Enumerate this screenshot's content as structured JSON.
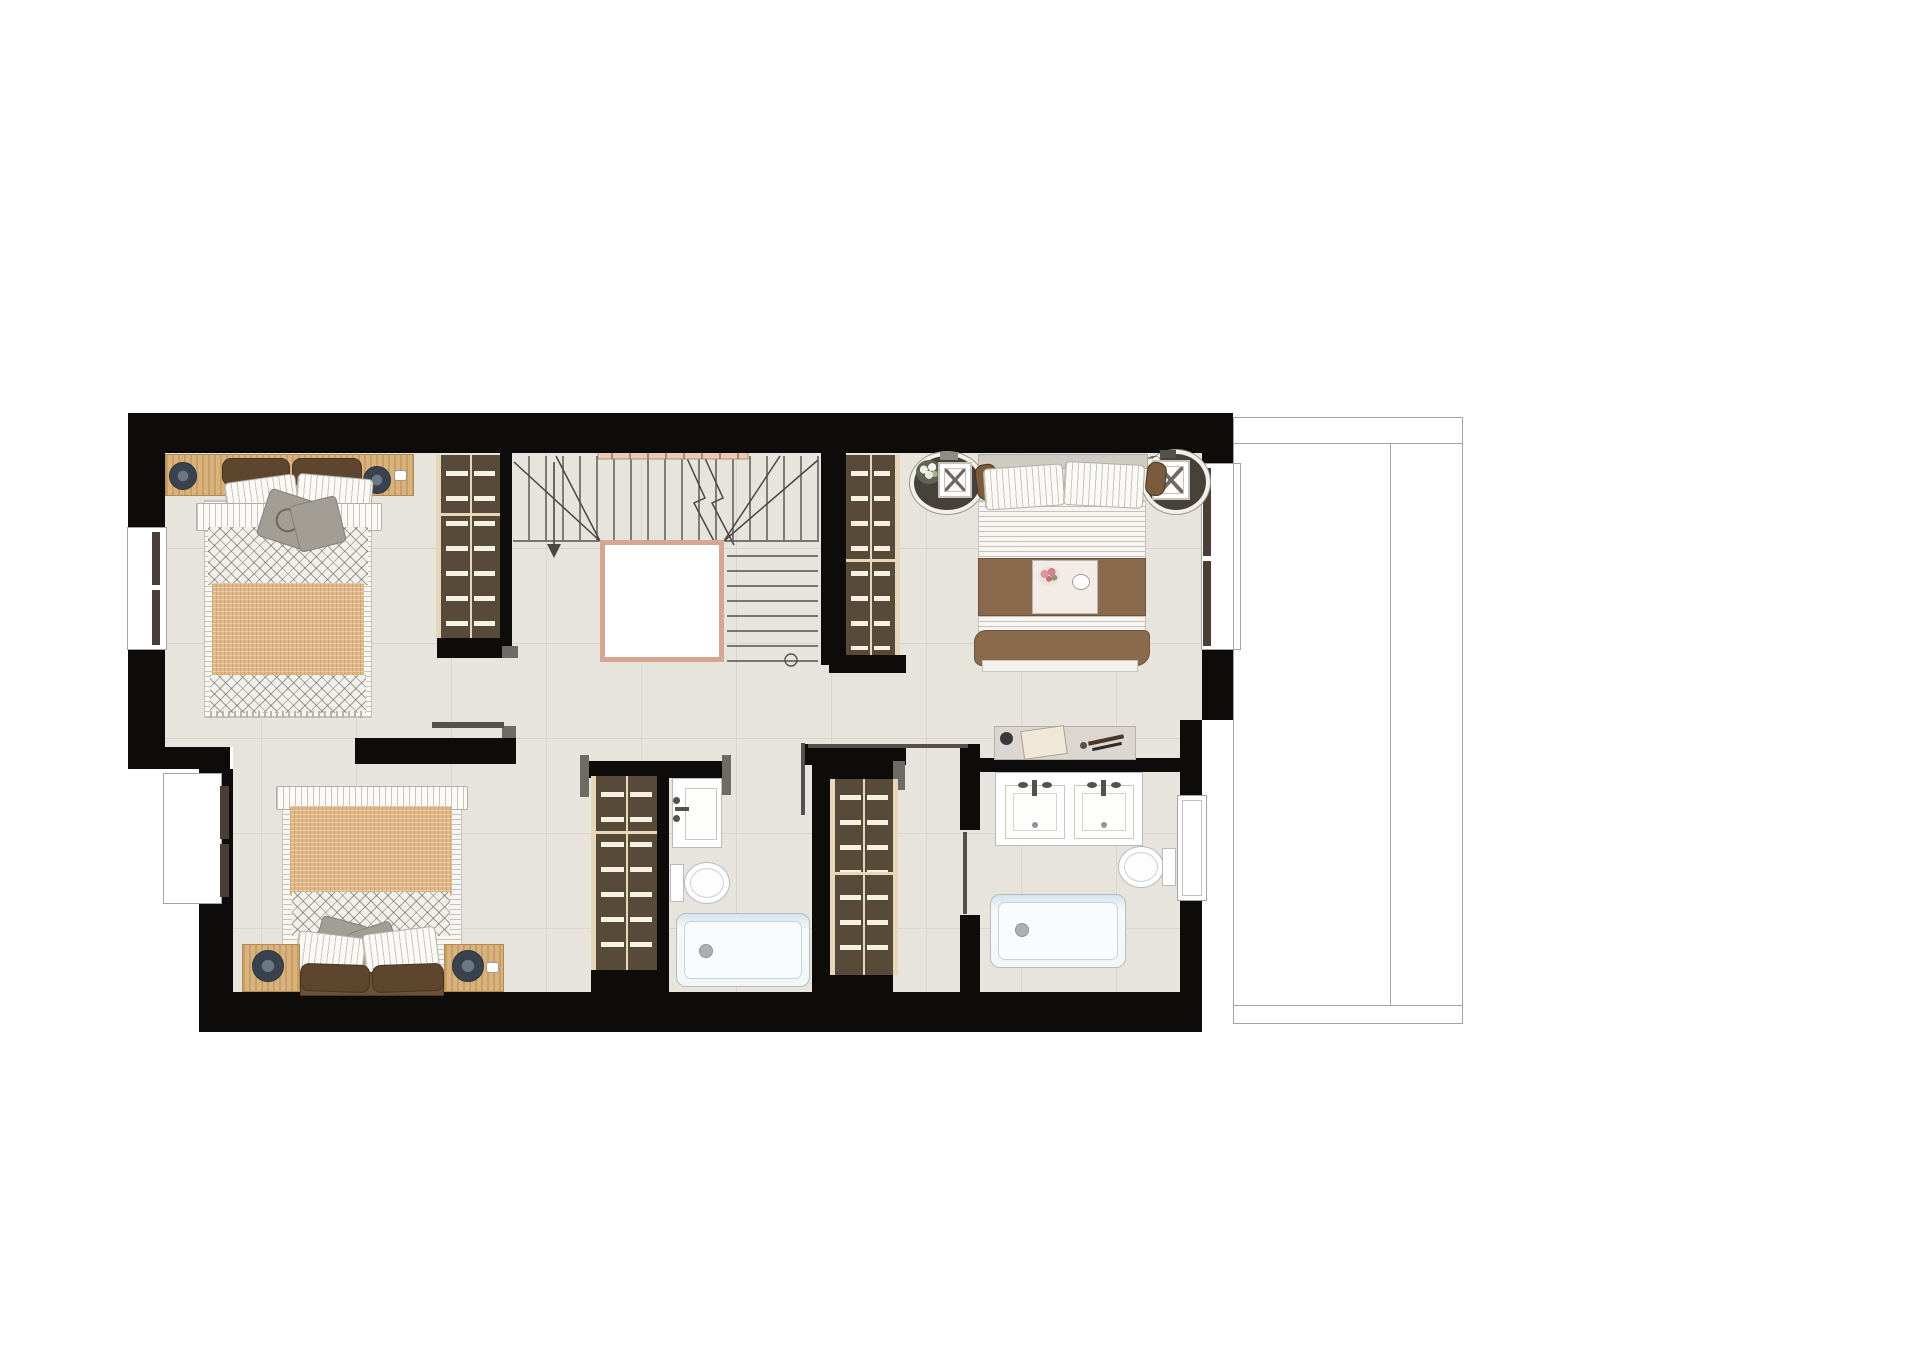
{
  "document": {
    "type": "architectural-floor-plan-rendering",
    "visible_text": [],
    "notes": "Top-down rendered floor plan of an upper storey: two bedrooms on the left, master bedroom top-right, central U-shaped staircase with open void, two bathrooms, four built-in wardrobes, and a thin-line terrace outline to the right."
  },
  "palette": {
    "wall": "#0d0c0a",
    "floor": "#e7e3dd",
    "floorline": "#dbd5cd",
    "wood": "#d9b27c",
    "wardrobe": "#584a39",
    "rail": "#e6d7b8",
    "brown": "#8a6a4d",
    "cushion": "#5e452d",
    "tan": "#dfb787",
    "gray": "#a29d95",
    "voidborder": "#d4a890",
    "stairline": "#54504a",
    "railing": "#ecc9b4",
    "terrace": "#a6a49e"
  },
  "legend": {
    "rooms": [
      "bedroom-top-left",
      "bedroom-bottom-left",
      "master-bedroom",
      "bathroom-middle",
      "bathroom-master",
      "stair-hall"
    ],
    "symbols": [
      "double-bed",
      "single-bed-wide",
      "wardrobe-rail-dashes",
      "stair-void",
      "stair-treads",
      "walk-line-arrow",
      "washbasin",
      "double-washbasin",
      "toilet",
      "bathtub",
      "nightstand-lamp",
      "oval-side-table",
      "window-recess",
      "door-leaf",
      "terrace-outline"
    ]
  }
}
